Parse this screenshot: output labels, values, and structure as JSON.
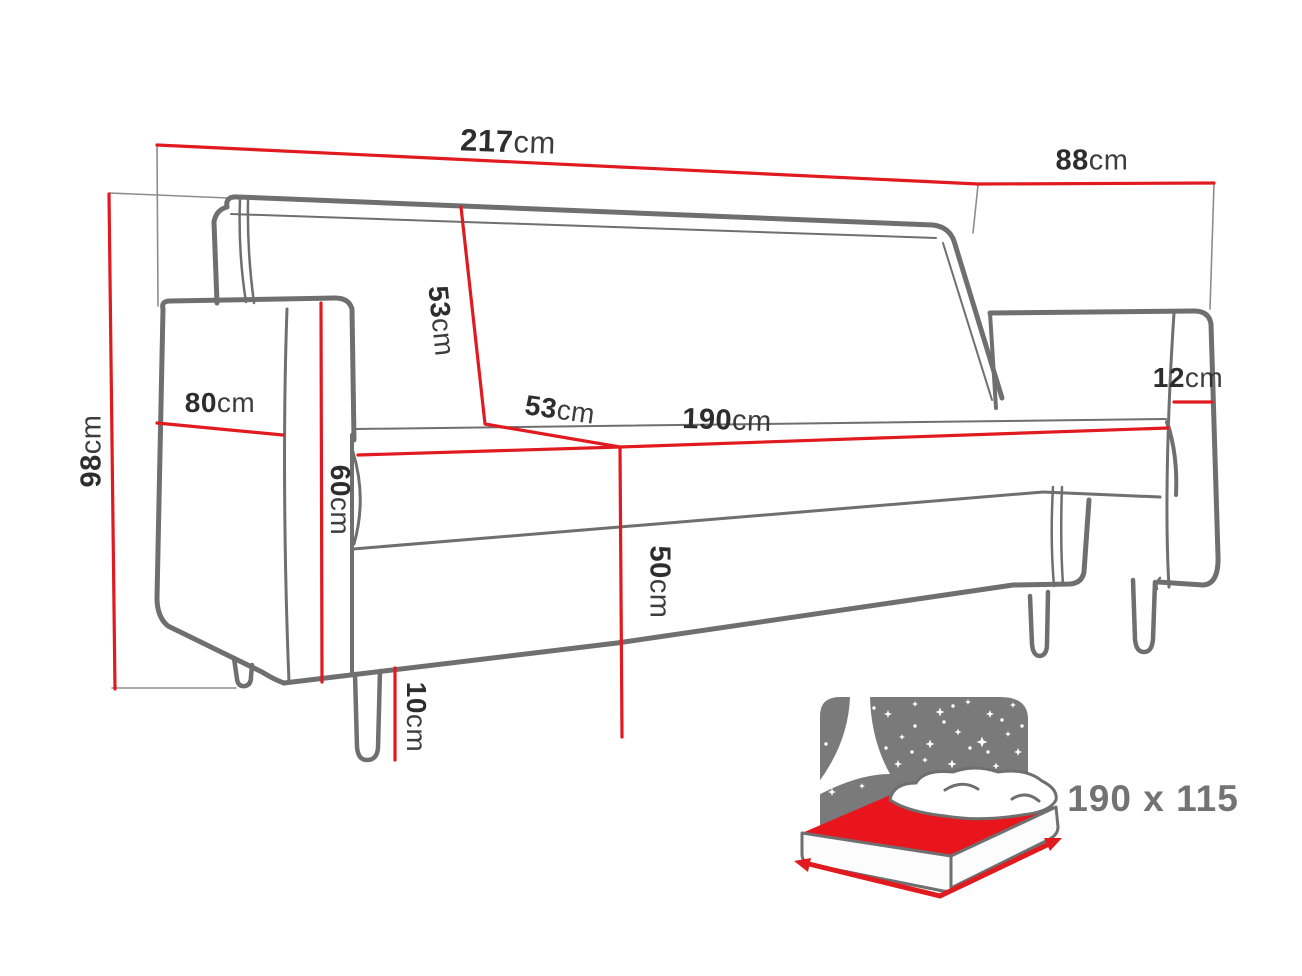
{
  "colors": {
    "dimension_line_red": "#e11a20",
    "sofa_outline_gray": "#6f6f6f",
    "label_text": "#2d2d2d",
    "bed_icon_gray": "#7a7a7a",
    "bed_mattress_red": "#e8151c",
    "bed_icon_text": "#737373"
  },
  "labels": {
    "total_width": {
      "value": "217",
      "unit": "cm"
    },
    "total_depth": {
      "value": "88",
      "unit": "cm"
    },
    "total_height": {
      "value": "98",
      "unit": "cm"
    },
    "backrest_height": {
      "value": "53",
      "unit": "cm"
    },
    "armrest_depth": {
      "value": "80",
      "unit": "cm"
    },
    "armrest_height": {
      "value": "60",
      "unit": "cm"
    },
    "seat_depth": {
      "value": "53",
      "unit": "cm"
    },
    "seat_width": {
      "value": "190",
      "unit": "cm"
    },
    "armrest_width": {
      "value": "12",
      "unit": "cm"
    },
    "seat_height": {
      "value": "50",
      "unit": "cm"
    },
    "leg_height": {
      "value": "10",
      "unit": "cm"
    }
  },
  "sleeping_area": {
    "label": "190 x 115"
  },
  "icons": [
    "sofa-line-drawing",
    "bed-sleeping-area-icon"
  ]
}
